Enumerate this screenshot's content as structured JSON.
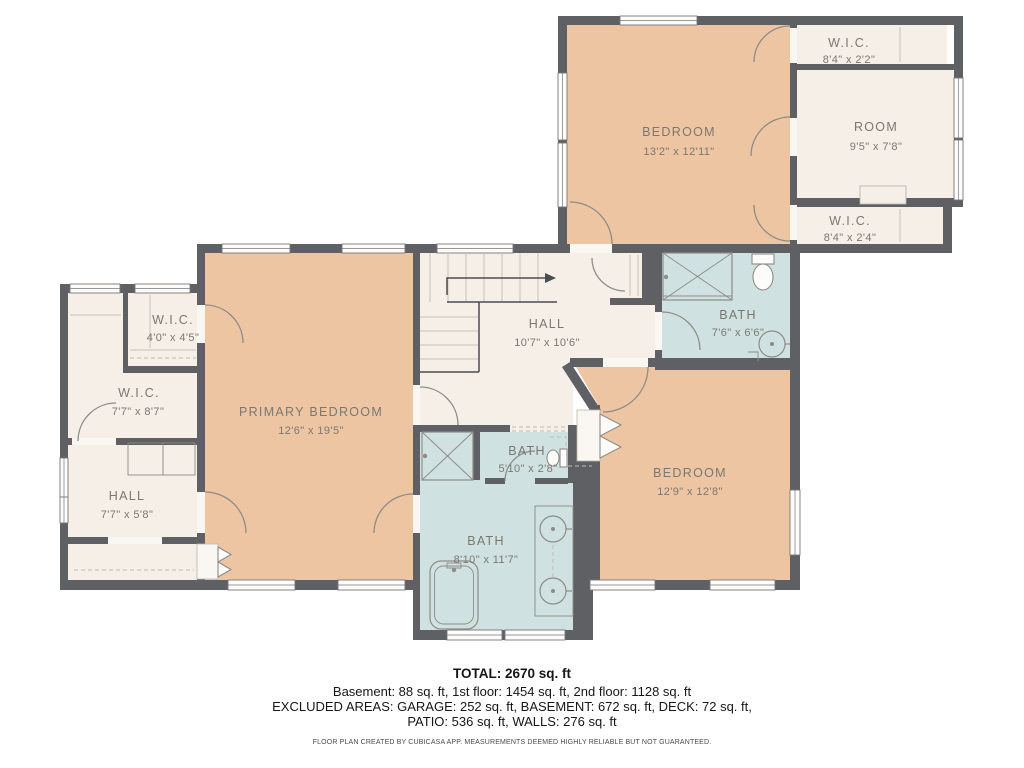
{
  "rooms": {
    "bedroom_top": {
      "name": "BEDROOM",
      "dims": "13'2\" x 12'11\""
    },
    "room": {
      "name": "ROOM",
      "dims": "9'5\" x 7'8\""
    },
    "wic_top": {
      "name": "W.I.C.",
      "dims": "8'4\" x 2'2\""
    },
    "wic_bottom": {
      "name": "W.I.C.",
      "dims": "8'4\" x 2'4\""
    },
    "bath_upper": {
      "name": "BATH",
      "dims": "7'6\" x 6'6\""
    },
    "hall_upper": {
      "name": "HALL",
      "dims": "10'7\" x 10'6\""
    },
    "bedroom_right": {
      "name": "BEDROOM",
      "dims": "12'9\" x 12'8\""
    },
    "bath_small": {
      "name": "BATH",
      "dims": "5'10\" x 2'8\""
    },
    "bath_main": {
      "name": "BATH",
      "dims": "8'10\" x 11'7\""
    },
    "primary": {
      "name": "PRIMARY BEDROOM",
      "dims": "12'6\" x 19'5\""
    },
    "wic_small": {
      "name": "W.I.C.",
      "dims": "4'0\" x 4'5\""
    },
    "wic_left": {
      "name": "W.I.C.",
      "dims": "7'7\" x 8'7\""
    },
    "hall_lower": {
      "name": "HALL",
      "dims": "7'7\" x 5'8\""
    }
  },
  "summary": {
    "total": "TOTAL: 2670 sq. ft",
    "floors": "Basement: 88 sq. ft, 1st floor: 1454 sq. ft, 2nd floor: 1128 sq. ft",
    "excluded1": "EXCLUDED AREAS: GARAGE: 252 sq. ft, BASEMENT: 672 sq. ft, DECK: 72 sq. ft,",
    "excluded2": "PATIO: 536 sq. ft, WALLS: 276 sq. ft",
    "disclaimer": "FLOOR PLAN CREATED BY CUBICASA APP. MEASUREMENTS DEEMED HIGHLY RELIABLE BUT NOT GUARANTEED."
  },
  "colors": {
    "wall": "#5e6063",
    "bedroom_fill": "#edc5a3",
    "hall_fill": "#f5efe8",
    "bath_fill": "#d0e1e1",
    "label_text": "#7b7870"
  }
}
